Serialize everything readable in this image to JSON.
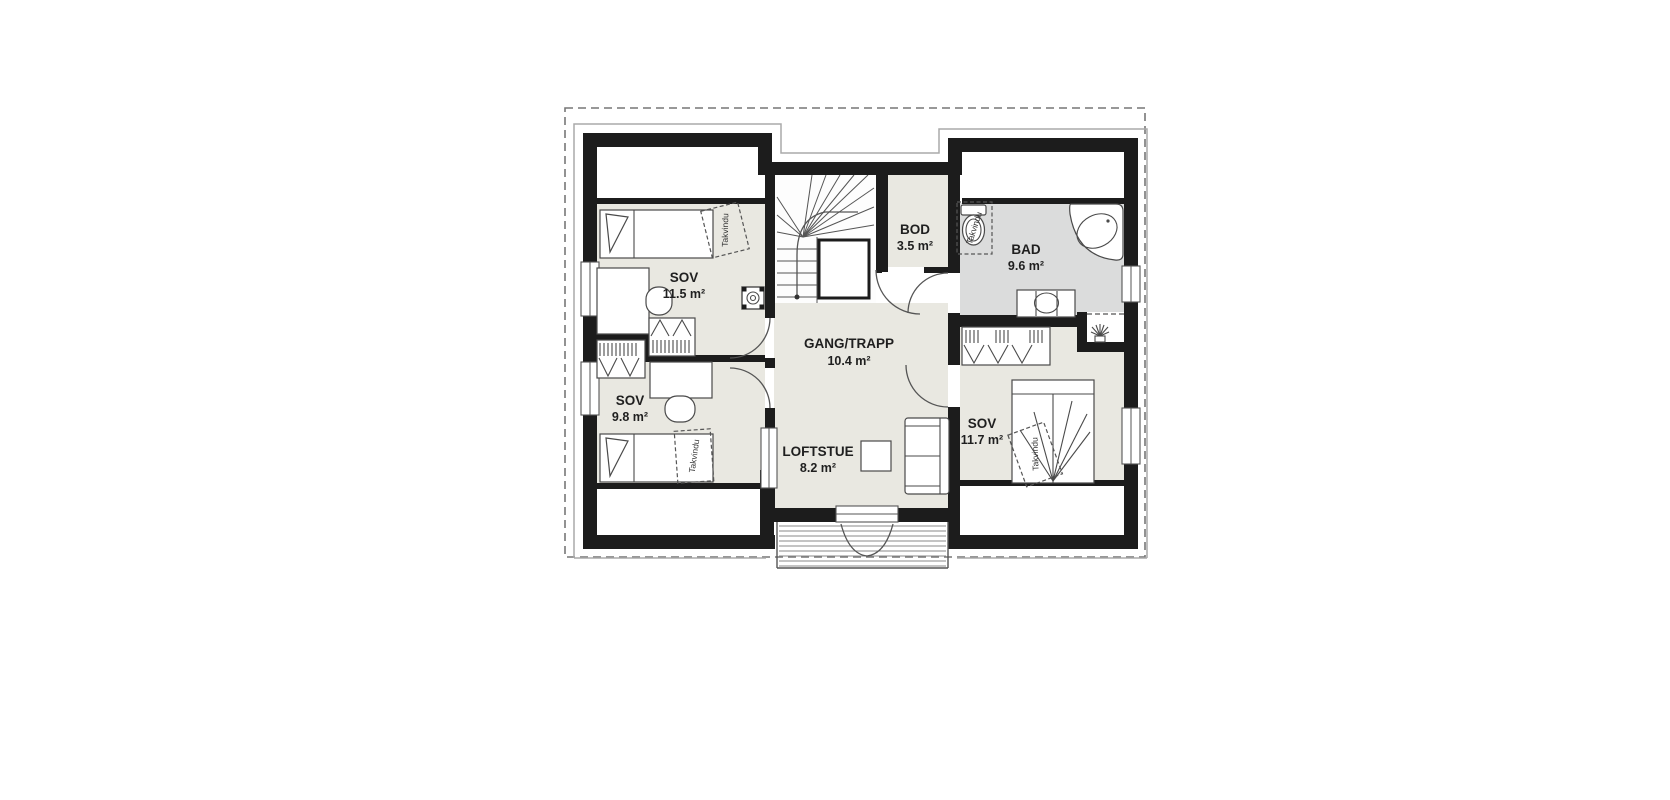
{
  "plan": {
    "title": "Loft floor plan",
    "rooms": [
      {
        "id": "sov-11-5",
        "label": "SOV",
        "area": "11.5 m²"
      },
      {
        "id": "sov-9-8",
        "label": "SOV",
        "area": "9.8 m²"
      },
      {
        "id": "gang-trapp",
        "label": "GANG/TRAPP",
        "area": "10.4 m²"
      },
      {
        "id": "loftstue",
        "label": "LOFTSTUE",
        "area": "8.2 m²"
      },
      {
        "id": "bod",
        "label": "BOD",
        "area": "3.5 m²"
      },
      {
        "id": "bad",
        "label": "BAD",
        "area": "9.6 m²"
      },
      {
        "id": "sov-11-7",
        "label": "SOV",
        "area": "11.7 m²"
      }
    ],
    "annotations": {
      "roof_window": "Takvindu"
    },
    "colors": {
      "wall": "#1c1c1c",
      "room_floor": "#e9e8e1",
      "bath_floor": "#dbdcdc",
      "stair_floor": "#fdfdfd",
      "eaves_outline": "#aaaaaa",
      "boundary_dash": "#777777",
      "furniture_stroke": "#4a4a4a"
    }
  }
}
